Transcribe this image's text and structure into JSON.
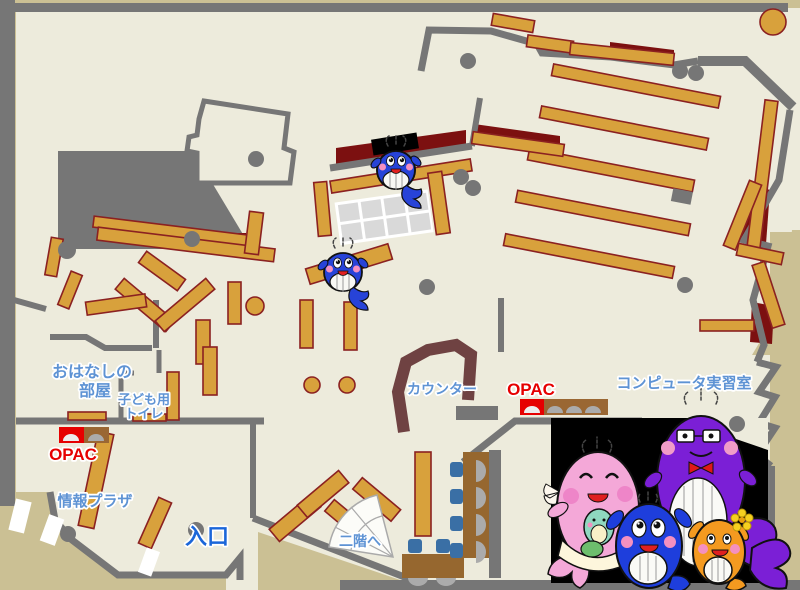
{
  "labels": {
    "storytelling_room_line1": "おはなしの",
    "storytelling_room_line2": "部屋",
    "kids_toilet_line1": "子ども用",
    "kids_toilet_line2": "トイレ",
    "opac_left": "OPAC",
    "info_plaza": "情報プラザ",
    "entrance": "入口",
    "counter": "カウンター",
    "opac_right": "OPAC",
    "computer_room": "コンピュータ実習室",
    "to_second_floor": "二階へ"
  },
  "colors": {
    "outer_tan": "#CBC094",
    "floor_cream": "#EDEBDC",
    "wall_gray": "#767676",
    "shelf_orange": "#D8A13C",
    "shelf_border": "#8B2121",
    "maroon_area": "#7C1010",
    "counter_brown": "#6F4242",
    "desk_brown": "#96672F",
    "chair_blue": "#3A6FA5",
    "monitor_gray": "#ABABAB",
    "grid_gray": "#D9D9D9",
    "label_blue": "#5E93D4",
    "entrance_blue": "#1B66D9",
    "opac_red": "#E60000",
    "photo_black": "#000000",
    "whale_blue": "#2743D8",
    "mascot_pink": "#F4A8D8",
    "mascot_purple": "#7B1FD6",
    "mascot_orange": "#F49A20",
    "mascot_mint": "#8FD8C0"
  },
  "icons": {
    "whale_mascot": "cartoon-whale",
    "mascot_family_photo": "four-whale-family",
    "stairs": "stair-fan",
    "opac_terminal": "arched-kiosk",
    "pillar": "gray-circle",
    "door": "white-gap"
  }
}
